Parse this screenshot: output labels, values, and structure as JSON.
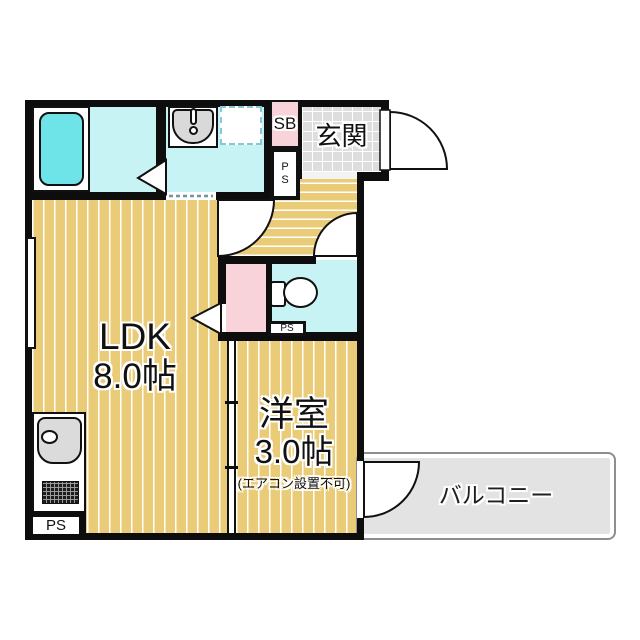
{
  "plan": {
    "rooms": {
      "ldk": {
        "name": "LDK",
        "size": "8.0帖"
      },
      "western_room": {
        "name": "洋室",
        "size": "3.0帖",
        "note": "(エアコン設置不可)"
      },
      "entrance": {
        "label": "玄関"
      },
      "balcony": {
        "label": "バルコニー"
      },
      "shoe_box": {
        "label": "SB"
      },
      "pipe_space": {
        "label": "PS"
      }
    },
    "colors": {
      "wall": "#0d0d0d",
      "wood_floor": "#EACB77",
      "wet_area_floor": "#C8F3F5",
      "bathtub": "#6FE4E8",
      "closet_pink": "#F8D3D9",
      "entrance_tile": "#DEDEDE",
      "balcony_gray": "#E3E3E3"
    }
  }
}
